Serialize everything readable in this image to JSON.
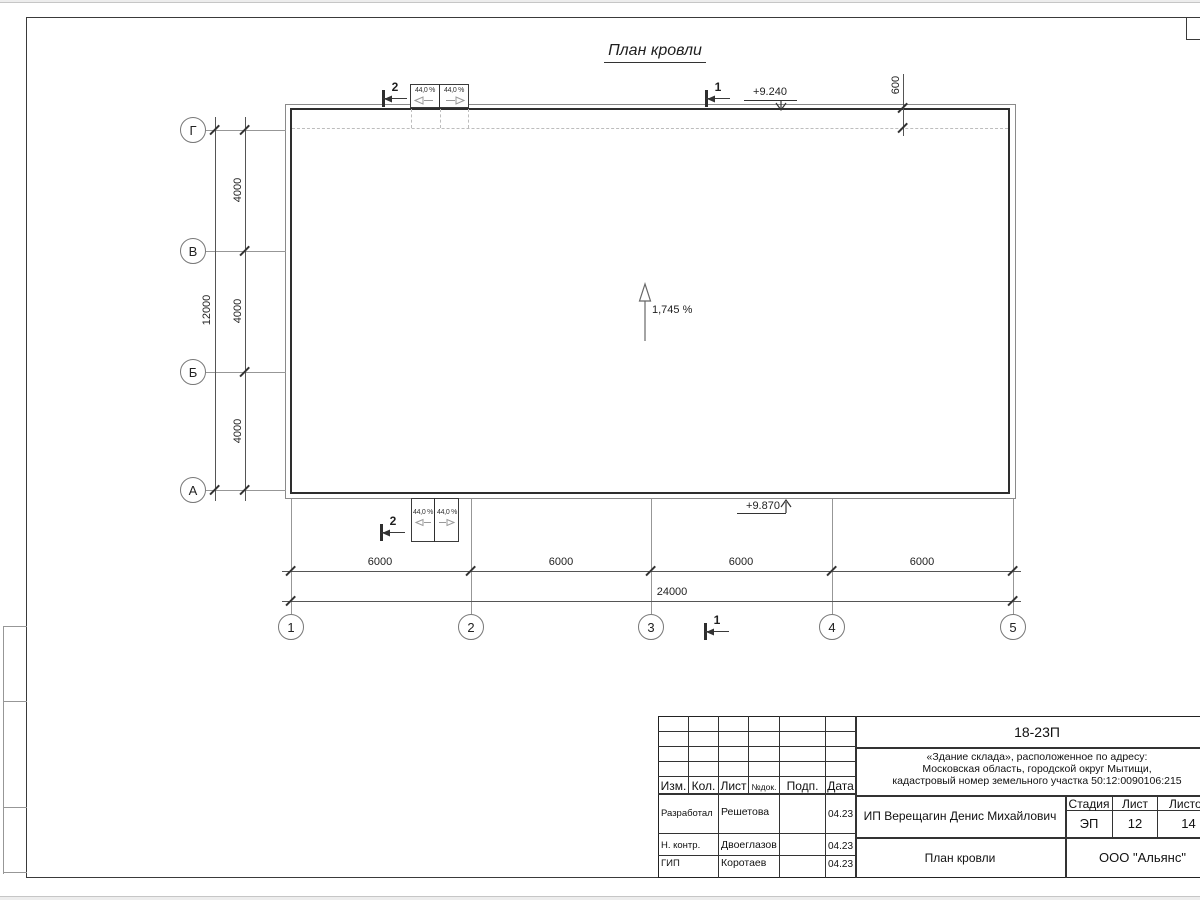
{
  "drawing": {
    "title": "План кровли",
    "slope_main": "1,745 %",
    "slope_canopy": "44,0 %",
    "elevation_top": "+9.240",
    "elevation_bottom": "+9.870",
    "section_1": "1",
    "section_2": "2",
    "axes_rows": [
      "Г",
      "В",
      "Б",
      "А"
    ],
    "axes_cols": [
      "1",
      "2",
      "3",
      "4",
      "5"
    ],
    "dims": {
      "row_segment": "4000",
      "row_total": "12000",
      "col_segment": "6000",
      "col_total": "24000",
      "overhang": "600"
    }
  },
  "title_block": {
    "doc_number": "18-23П",
    "object_line1": "«Здание склада», расположенное по адресу:",
    "object_line2": "Московская область, городской округ Мытищи,",
    "object_line3": "кадастровый номер земельного участка 50:12:0090106:215",
    "client": "ИП Верещагин Денис Михайлович",
    "sheet_title": "План кровли",
    "company": "ООО \"Альянс\"",
    "cols": {
      "izm": "Изм.",
      "kol": "Кол.",
      "list": "Лист",
      "doc": "№док.",
      "podp": "Подп.",
      "data": "Дата"
    },
    "stage_label": "Стадия",
    "stage": "ЭП",
    "sheet_label": "Лист",
    "sheet": "12",
    "sheets_label": "Листов",
    "sheets": "14",
    "row1": {
      "role": "Разработал",
      "name": "Решетова",
      "date": "04.23"
    },
    "row2": {
      "role": "Н. контр.",
      "name": "Двоеглазов",
      "date": "04.23"
    },
    "row3": {
      "role": "ГИП",
      "name": "Коротаев",
      "date": "04.23"
    }
  }
}
